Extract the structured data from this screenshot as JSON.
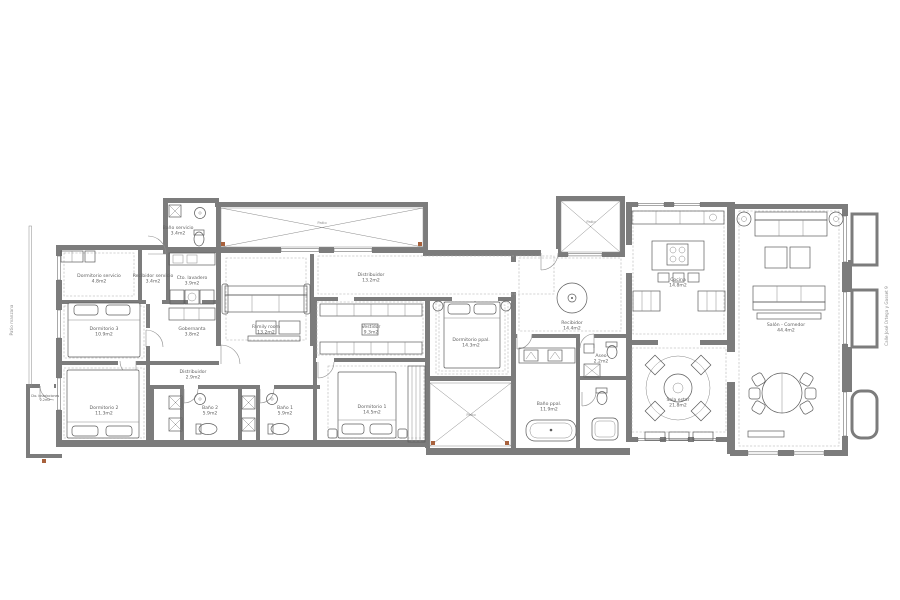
{
  "plan": {
    "edge_labels": {
      "left": "Patio manzana",
      "right": "Calle José Ortega y Gasset 9"
    },
    "patio_label": "Patio",
    "rooms": [
      {
        "name": "Dormitorio servicio",
        "area": "4.8m2"
      },
      {
        "name": "Recibidor servicio",
        "area": "3.4m2"
      },
      {
        "name": "Baño servicio",
        "area": "3.4m2"
      },
      {
        "name": "Cto. lavadero",
        "area": "3.9m2"
      },
      {
        "name": "Dormitorio 3",
        "area": "10.9m2"
      },
      {
        "name": "Gobernanta",
        "area": "3.8m2"
      },
      {
        "name": "Distribuidor",
        "area": "2.9m2"
      },
      {
        "name": "Dormitorio 2",
        "area": "11.3m2"
      },
      {
        "name": "Cto. instalaciones",
        "area": "2.2m2"
      },
      {
        "name": "Family room",
        "area": "13.2m2"
      },
      {
        "name": "Distribuidor",
        "area": "13.2m2"
      },
      {
        "name": "Vestidor",
        "area": "9.3m2"
      },
      {
        "name": "Baño 2",
        "area": "5.9m2"
      },
      {
        "name": "Baño 1",
        "area": "5.9m2"
      },
      {
        "name": "Dormitorio 1",
        "area": "14.5m2"
      },
      {
        "name": "Dormitorio ppal.",
        "area": "14.3m2"
      },
      {
        "name": "Baño ppal.",
        "area": "11.9m2"
      },
      {
        "name": "Aseo",
        "area": "2.2m2"
      },
      {
        "name": "Recibidor",
        "area": "14.4m2"
      },
      {
        "name": "Cocina",
        "area": "14.8m2"
      },
      {
        "name": "Sala estar",
        "area": "21.8m2"
      },
      {
        "name": "Salón - Comedor",
        "area": "44.4m2"
      }
    ],
    "colors": {
      "wall": "#7c7c7c",
      "accent": "#a8613c",
      "text": "#606060"
    }
  }
}
